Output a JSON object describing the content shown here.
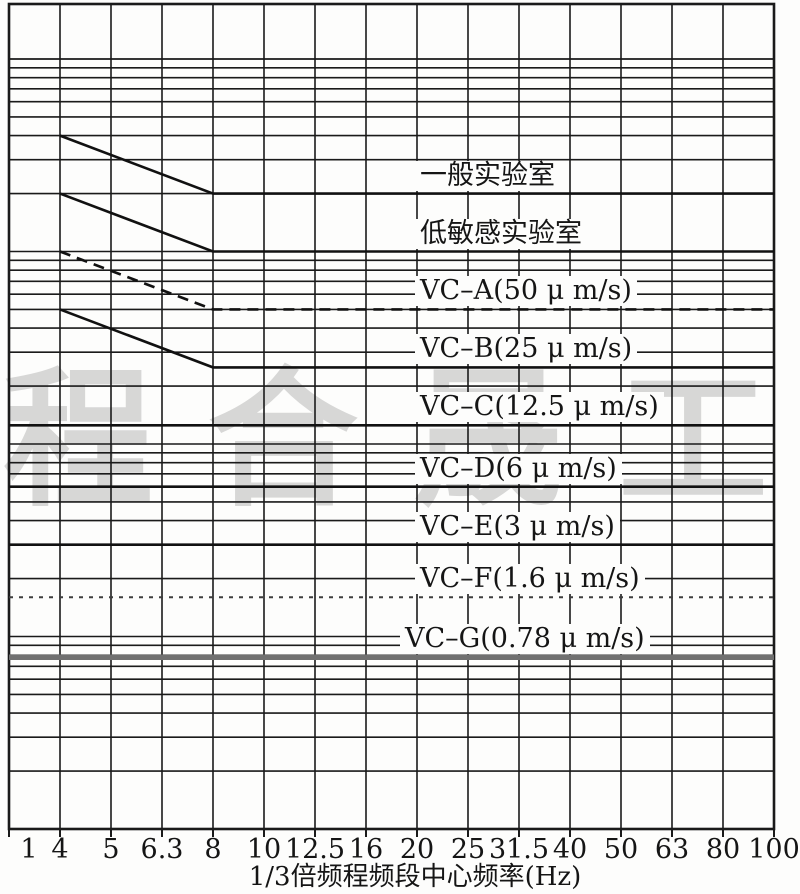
{
  "watermark": {
    "text": "合晟工程",
    "color": "#9a9a9a"
  },
  "colors": {
    "grid": "#1a1a1a",
    "curve": "#111111",
    "vc_g_band": "#707070",
    "background": "#fdfdfc"
  },
  "chart_data": {
    "type": "line",
    "title": "",
    "xlabel": "1/3倍频程频段中心频率(Hz)",
    "ylabel": "",
    "x_scale": "one-third octave bands, evenly spaced ticks",
    "y_scale": "log, unlabeled velocity axis in μm/s",
    "x_tick_values": [
      1,
      4,
      5,
      6.3,
      8,
      10,
      12.5,
      16,
      20,
      25,
      31.5,
      40,
      50,
      63,
      80,
      100
    ],
    "x_tick_labels": [
      "1",
      "4",
      "5",
      "6.3",
      "8",
      "10",
      "12.5",
      "16",
      "20",
      "25",
      "31.5",
      "40",
      "50",
      "63",
      "80",
      "100"
    ],
    "y_range": [
      0.1,
      1000
    ],
    "grid": "full log-log grid, all 1-9 mantissa lines over 4 decades",
    "legend_position": "labels printed above each curve inside plot",
    "series": [
      {
        "id": "general-lab",
        "label": "一般实验室",
        "style": "solid",
        "points": [
          {
            "hz": 4,
            "v": 400
          },
          {
            "hz": 8,
            "v": 200
          },
          {
            "hz": 100,
            "v": 200
          }
        ]
      },
      {
        "id": "low-sensitive-lab",
        "label": "低敏感实验室",
        "style": "solid",
        "points": [
          {
            "hz": 4,
            "v": 200
          },
          {
            "hz": 8,
            "v": 100
          },
          {
            "hz": 100,
            "v": 100
          }
        ]
      },
      {
        "id": "vc-a",
        "label": "VC–A(50 μ m/s)",
        "style": "dashed",
        "points": [
          {
            "hz": 4,
            "v": 100
          },
          {
            "hz": 8,
            "v": 50
          },
          {
            "hz": 100,
            "v": 50
          }
        ]
      },
      {
        "id": "vc-b",
        "label": "VC–B(25 μ m/s)",
        "style": "solid",
        "points": [
          {
            "hz": 4,
            "v": 50
          },
          {
            "hz": 8,
            "v": 25
          },
          {
            "hz": 100,
            "v": 25
          }
        ]
      },
      {
        "id": "vc-c",
        "label": "VC–C(12.5 μ m/s)",
        "style": "solid",
        "points": [
          {
            "hz": 1,
            "v": 12.5
          },
          {
            "hz": 100,
            "v": 12.5
          }
        ]
      },
      {
        "id": "vc-d",
        "label": "VC–D(6 μ m/s)",
        "style": "solid",
        "points": [
          {
            "hz": 1,
            "v": 6
          },
          {
            "hz": 100,
            "v": 6
          }
        ]
      },
      {
        "id": "vc-e",
        "label": "VC–E(3 μ m/s)",
        "style": "solid",
        "points": [
          {
            "hz": 1,
            "v": 3
          },
          {
            "hz": 100,
            "v": 3
          }
        ]
      },
      {
        "id": "vc-f",
        "label": "VC–F(1.6 μ m/s)",
        "style": "dashed-fine",
        "points": [
          {
            "hz": 1,
            "v": 1.6
          },
          {
            "hz": 100,
            "v": 1.6
          }
        ]
      },
      {
        "id": "vc-g",
        "label": "VC–G(0.78 μ m/s)",
        "style": "thick-gray",
        "points": [
          {
            "hz": 1,
            "v": 0.78
          },
          {
            "hz": 100,
            "v": 0.78
          }
        ]
      }
    ]
  }
}
